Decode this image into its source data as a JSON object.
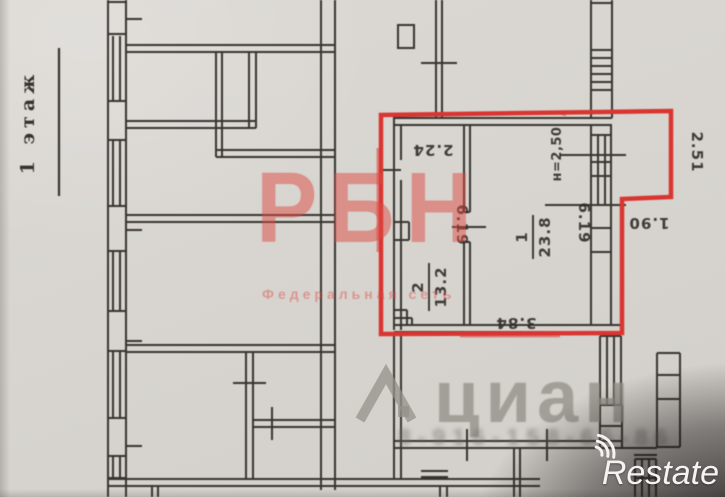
{
  "plan": {
    "floor_label": "1 этаж",
    "rooms": [
      {
        "number": "1",
        "area": "23.8"
      },
      {
        "number": "2",
        "area": "13.2"
      }
    ],
    "dimensions": {
      "room_top": "2.24",
      "depth_left": "6.19",
      "ceiling_height": "н=2,50",
      "depth_right": "6.19",
      "balcony_side": "2.51",
      "balcony_bottom": "1.90",
      "room1_bottom": "3.84"
    }
  },
  "watermarks": {
    "agency_name": "РБН",
    "agency_tagline": "Федеральная сеть",
    "portal_name": "циан",
    "blurred_number": "8-916-158-65-86",
    "corner_logo": "Restate"
  },
  "colors": {
    "paper": "#d8d5d0",
    "wall_ink": "#37342f",
    "unit_outline_red": "#d93531",
    "watermark_red": "#dd4942",
    "watermark_gray": "#94908a"
  }
}
